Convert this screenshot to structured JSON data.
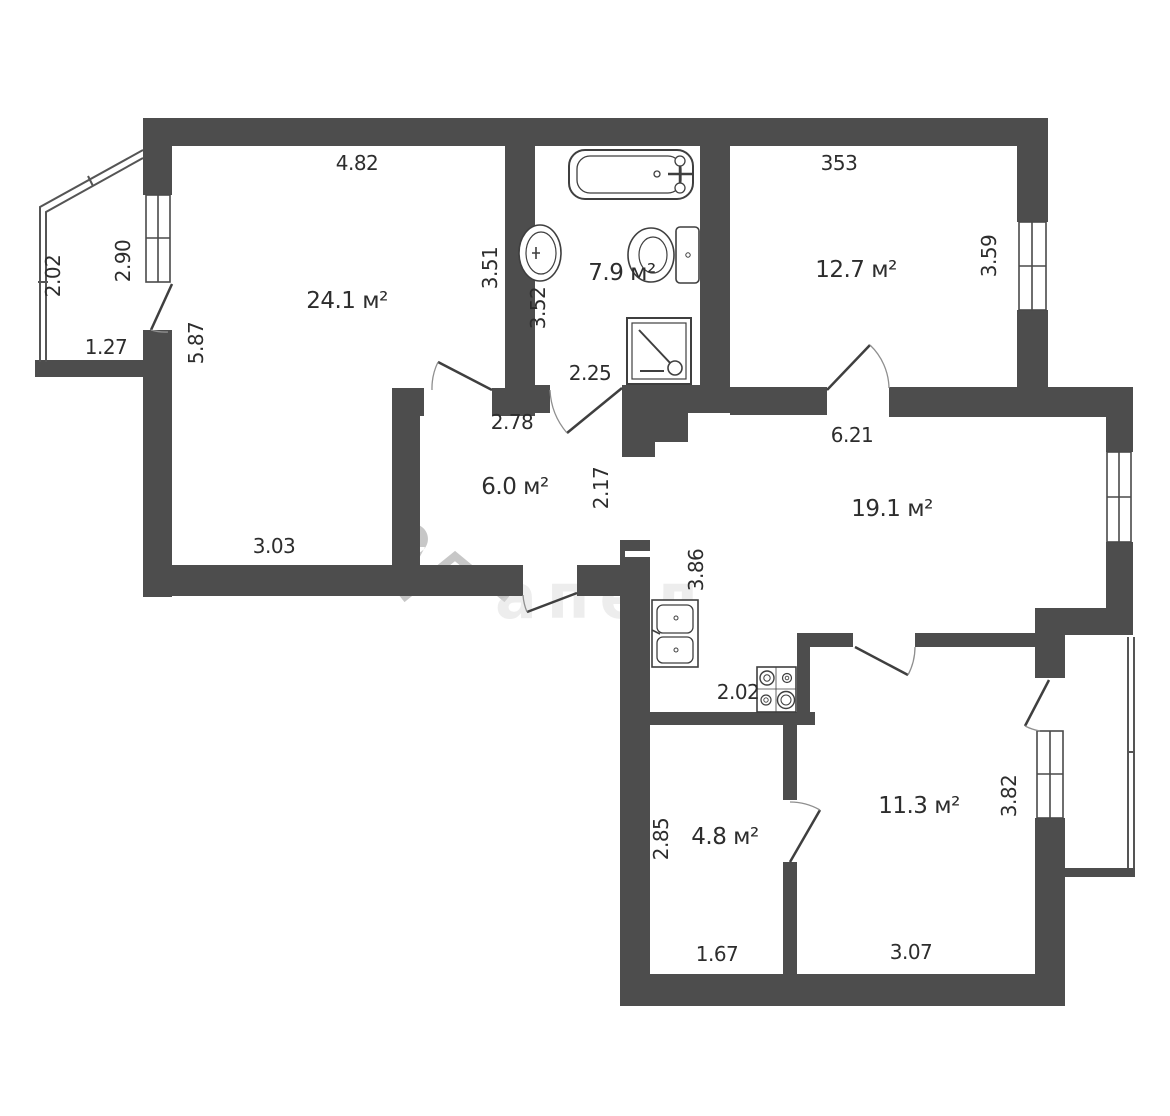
{
  "plan": {
    "watermark": {
      "text": "апед"
    },
    "rooms": [
      {
        "name": "living-room",
        "area": "24.1 м²"
      },
      {
        "name": "bathroom",
        "area": "7.9 м²"
      },
      {
        "name": "bedroom-top-right",
        "area": "12.7 м²"
      },
      {
        "name": "hallway",
        "area": "6.0 м²"
      },
      {
        "name": "kitchen-living",
        "area": "19.1 м²"
      },
      {
        "name": "storage-room",
        "area": "4.8 м²"
      },
      {
        "name": "bedroom-bottom",
        "area": "11.3 м²"
      }
    ],
    "dimensions": {
      "top_left": "4.82",
      "top_right": "353",
      "balcony_left_side": "2.02",
      "balcony_window": "2.90",
      "balcony_bottom": "1.27",
      "living_left": "5.87",
      "bath_wall_outer": "3.51",
      "bath_wall_inner": "3.52",
      "bath_bottom": "2.25",
      "hall_top": "2.78",
      "kitchen_top": "6.21",
      "bedroom_right_window": "3.59",
      "hall_right": "2.17",
      "kitchen_left": "3.86",
      "living_bottom": "3.03",
      "stove_width": "2.02",
      "storage_left": "2.85",
      "storage_bottom": "1.67",
      "bedroom_bottom_width": "3.07",
      "bedroom_bottom_window": "3.82"
    },
    "colors": {
      "wall": "#4d4d4d",
      "line": "#3f3f3f",
      "arc": "#8f8f8f",
      "watermark": "#a8a8a8"
    }
  }
}
